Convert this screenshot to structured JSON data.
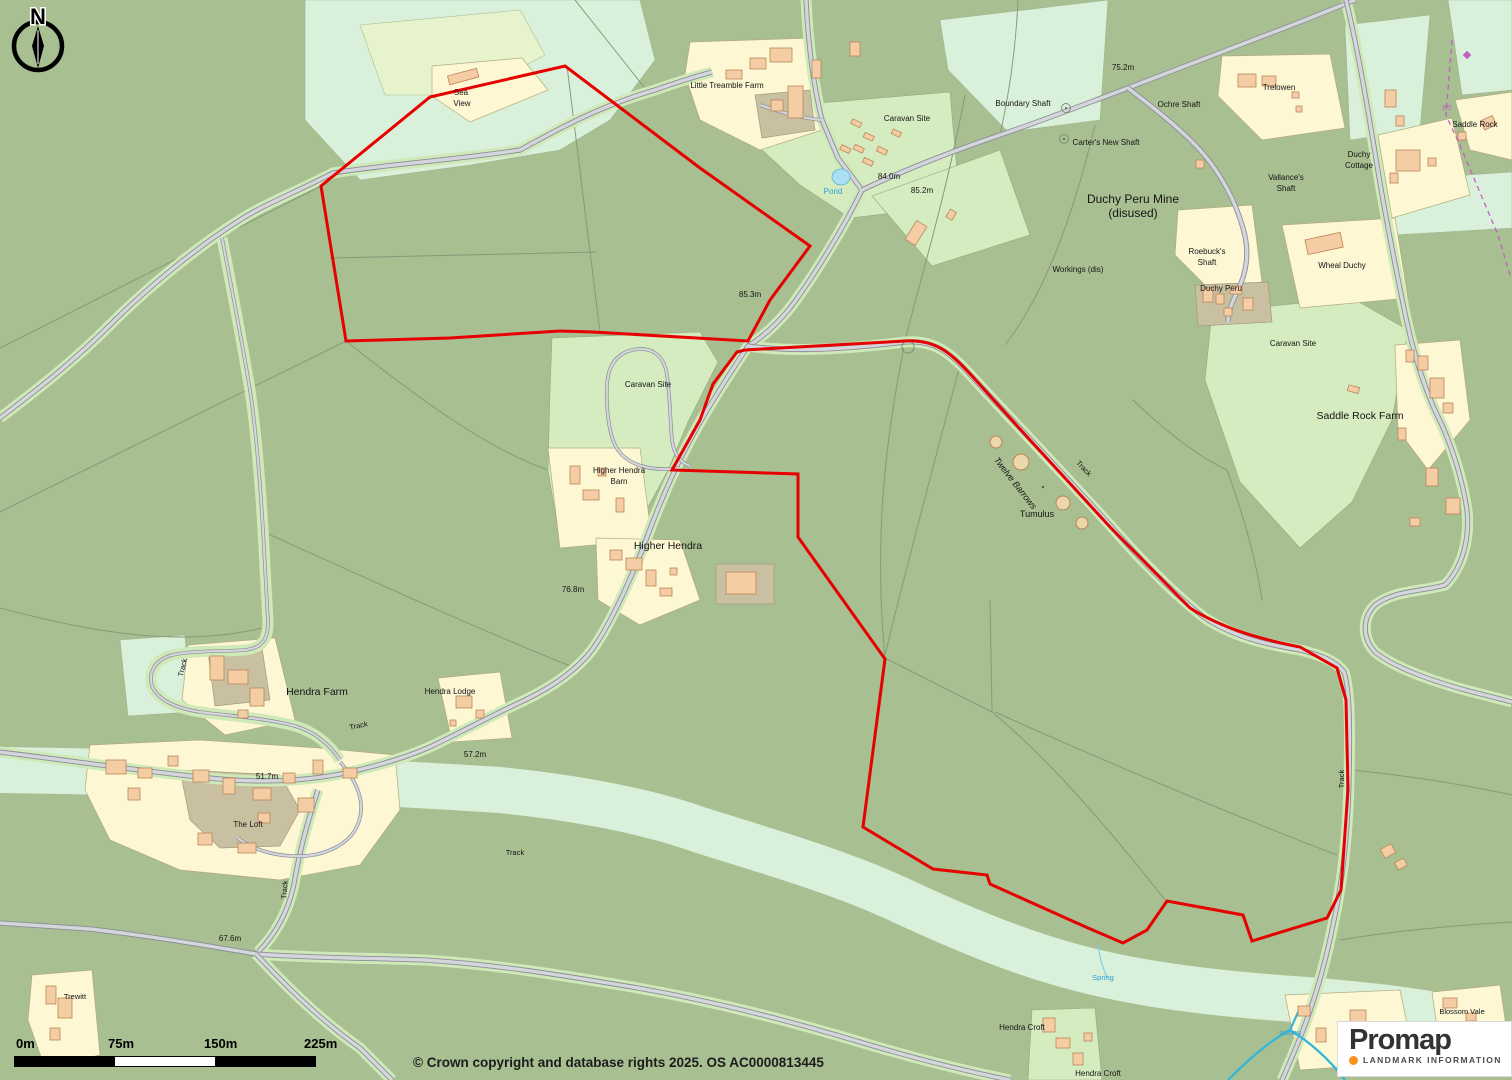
{
  "map": {
    "boundary_color": "#e60000",
    "water_text_color": "#2e9ed6",
    "boundary_stone_color": "#c45ec4",
    "labels": [
      {
        "t": "Sea",
        "x": 461,
        "y": 95,
        "s": 8
      },
      {
        "t": "View",
        "x": 462,
        "y": 106,
        "s": 8
      },
      {
        "t": "Little Treamble Farm",
        "x": 727,
        "y": 88,
        "s": 8
      },
      {
        "t": "Caravan Site",
        "x": 907,
        "y": 121,
        "s": 8
      },
      {
        "t": "Boundary Shaft",
        "x": 1023,
        "y": 106,
        "s": 8
      },
      {
        "t": "Carter's New Shaft",
        "x": 1106,
        "y": 145,
        "s": 8
      },
      {
        "t": "Ochre Shaft",
        "x": 1179,
        "y": 107,
        "s": 8
      },
      {
        "t": "Trelowen",
        "x": 1279,
        "y": 90,
        "s": 8
      },
      {
        "t": "75.2m",
        "x": 1123,
        "y": 70,
        "s": 8
      },
      {
        "t": "84.0m",
        "x": 889,
        "y": 179,
        "s": 8
      },
      {
        "t": "85.2m",
        "x": 922,
        "y": 193,
        "s": 8
      },
      {
        "t": "Pond",
        "x": 833,
        "y": 194,
        "s": 8,
        "c": "blue"
      },
      {
        "t": "Duchy Peru Mine",
        "x": 1133,
        "y": 203,
        "s": 12
      },
      {
        "t": "(disused)",
        "x": 1133,
        "y": 217,
        "s": 12
      },
      {
        "t": "Vallance's",
        "x": 1286,
        "y": 180,
        "s": 8
      },
      {
        "t": "Shaft",
        "x": 1286,
        "y": 191,
        "s": 8
      },
      {
        "t": "Duchy",
        "x": 1359,
        "y": 157,
        "s": 8
      },
      {
        "t": "Cottage",
        "x": 1359,
        "y": 168,
        "s": 8
      },
      {
        "t": "Saddle Rock",
        "x": 1475,
        "y": 127,
        "s": 8
      },
      {
        "t": "Roebuck's",
        "x": 1207,
        "y": 254,
        "s": 8
      },
      {
        "t": "Shaft",
        "x": 1207,
        "y": 265,
        "s": 8
      },
      {
        "t": "Duchy Peru",
        "x": 1221,
        "y": 291,
        "s": 8
      },
      {
        "t": "Workings (dis)",
        "x": 1078,
        "y": 272,
        "s": 8
      },
      {
        "t": "Wheal Duchy",
        "x": 1342,
        "y": 268,
        "s": 8
      },
      {
        "t": "Caravan Site",
        "x": 1293,
        "y": 346,
        "s": 8
      },
      {
        "t": "Saddle Rock Farm",
        "x": 1360,
        "y": 419,
        "s": 10.5
      },
      {
        "t": "85.3m",
        "x": 750,
        "y": 297,
        "s": 8
      },
      {
        "t": "Caravan Site",
        "x": 648,
        "y": 387,
        "s": 8
      },
      {
        "t": "Higher Hendra",
        "x": 619,
        "y": 473,
        "s": 8
      },
      {
        "t": "Barn",
        "x": 619,
        "y": 484,
        "s": 8
      },
      {
        "t": "Higher Hendra",
        "x": 668,
        "y": 549,
        "s": 10.5
      },
      {
        "t": "76.8m",
        "x": 573,
        "y": 592,
        "s": 8
      },
      {
        "t": "Twelve Barrows",
        "x": 1013,
        "y": 485,
        "s": 9,
        "r": 52,
        "i": 1
      },
      {
        "t": "Tumulus",
        "x": 1037,
        "y": 517,
        "s": 9
      },
      {
        "t": "Track",
        "x": 1082,
        "y": 470,
        "s": 7.5,
        "r": 47
      },
      {
        "t": "Track",
        "x": 185,
        "y": 668,
        "s": 7.5,
        "r": -76
      },
      {
        "t": "Hendra Farm",
        "x": 317,
        "y": 695,
        "s": 10.5
      },
      {
        "t": "Hendra Lodge",
        "x": 450,
        "y": 694,
        "s": 8
      },
      {
        "t": "Track",
        "x": 359,
        "y": 728,
        "s": 7.5,
        "r": -12
      },
      {
        "t": "57.2m",
        "x": 475,
        "y": 757,
        "s": 8
      },
      {
        "t": "51.7m",
        "x": 267,
        "y": 779,
        "s": 8
      },
      {
        "t": "The Loft",
        "x": 248,
        "y": 827,
        "s": 8
      },
      {
        "t": "Track",
        "x": 515,
        "y": 855,
        "s": 7.5
      },
      {
        "t": "Track",
        "x": 287,
        "y": 890,
        "s": 7.5,
        "r": -86
      },
      {
        "t": "67.6m",
        "x": 230,
        "y": 941,
        "s": 8
      },
      {
        "t": "Trewitt",
        "x": 75,
        "y": 999,
        "s": 7.5
      },
      {
        "t": "Track",
        "x": 1344,
        "y": 779,
        "s": 7.5,
        "r": -90
      },
      {
        "t": "Hendra Croft",
        "x": 1022,
        "y": 1030,
        "s": 8
      },
      {
        "t": "Hendra Croft",
        "x": 1098,
        "y": 1076,
        "s": 8
      },
      {
        "t": "Blossom Vale",
        "x": 1462,
        "y": 1014,
        "s": 7.5
      },
      {
        "t": "Spring",
        "x": 1103,
        "y": 980,
        "s": 7.5,
        "c": "blue"
      },
      {
        "t": "Issues",
        "x": 1290,
        "y": 1035,
        "s": 7.5,
        "c": "blue"
      },
      {
        "t": "BS",
        "x": 1447,
        "y": 110,
        "s": 7,
        "c": "magenta"
      }
    ]
  },
  "compass": {
    "letter": "N"
  },
  "scale_bar": {
    "labels": [
      "0m",
      "75m",
      "150m",
      "225m"
    ]
  },
  "copyright": "© Crown copyright and database rights 2025. OS AC0000813445",
  "logo": {
    "brand": "Promap",
    "tagline": "LANDMARK INFORMATION"
  }
}
